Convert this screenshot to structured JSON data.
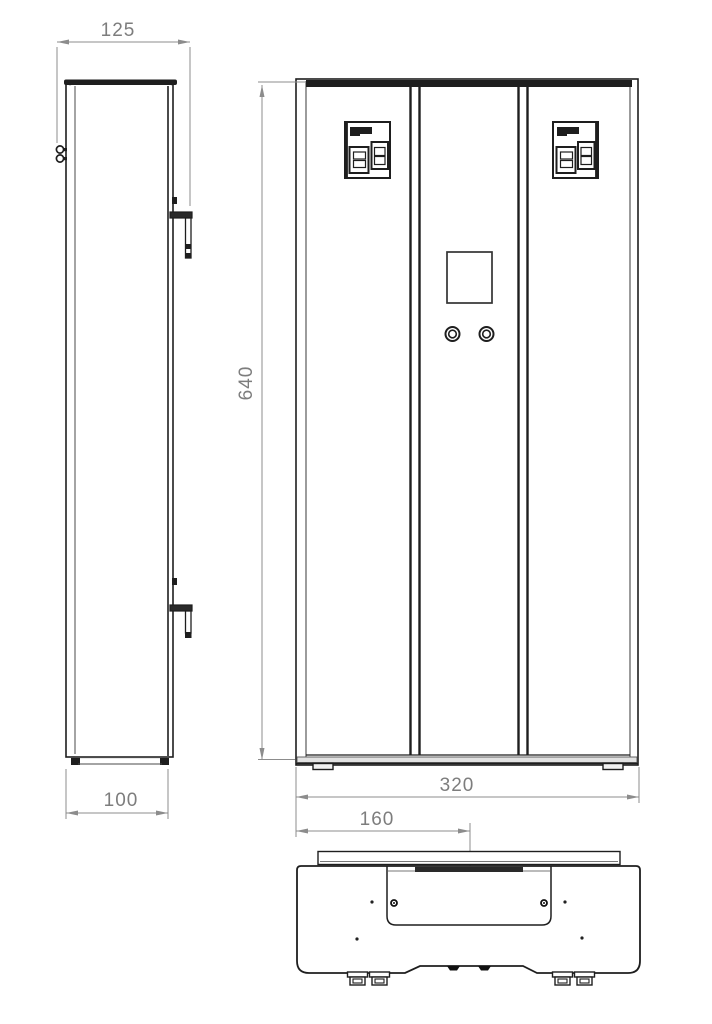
{
  "drawing": {
    "type": "three-view technical drawing of a wall-mounted electric unit",
    "colors": {
      "background": "#ffffff",
      "object_line": "#1e1e1e",
      "dimension_line": "#8c8c8c",
      "dimension_text": "#7d7d7d"
    }
  },
  "dimensions": {
    "side_depth_overall": "125",
    "side_depth_body": "100",
    "front_height": "640",
    "front_width": "320",
    "bottom_center_offset": "160"
  }
}
